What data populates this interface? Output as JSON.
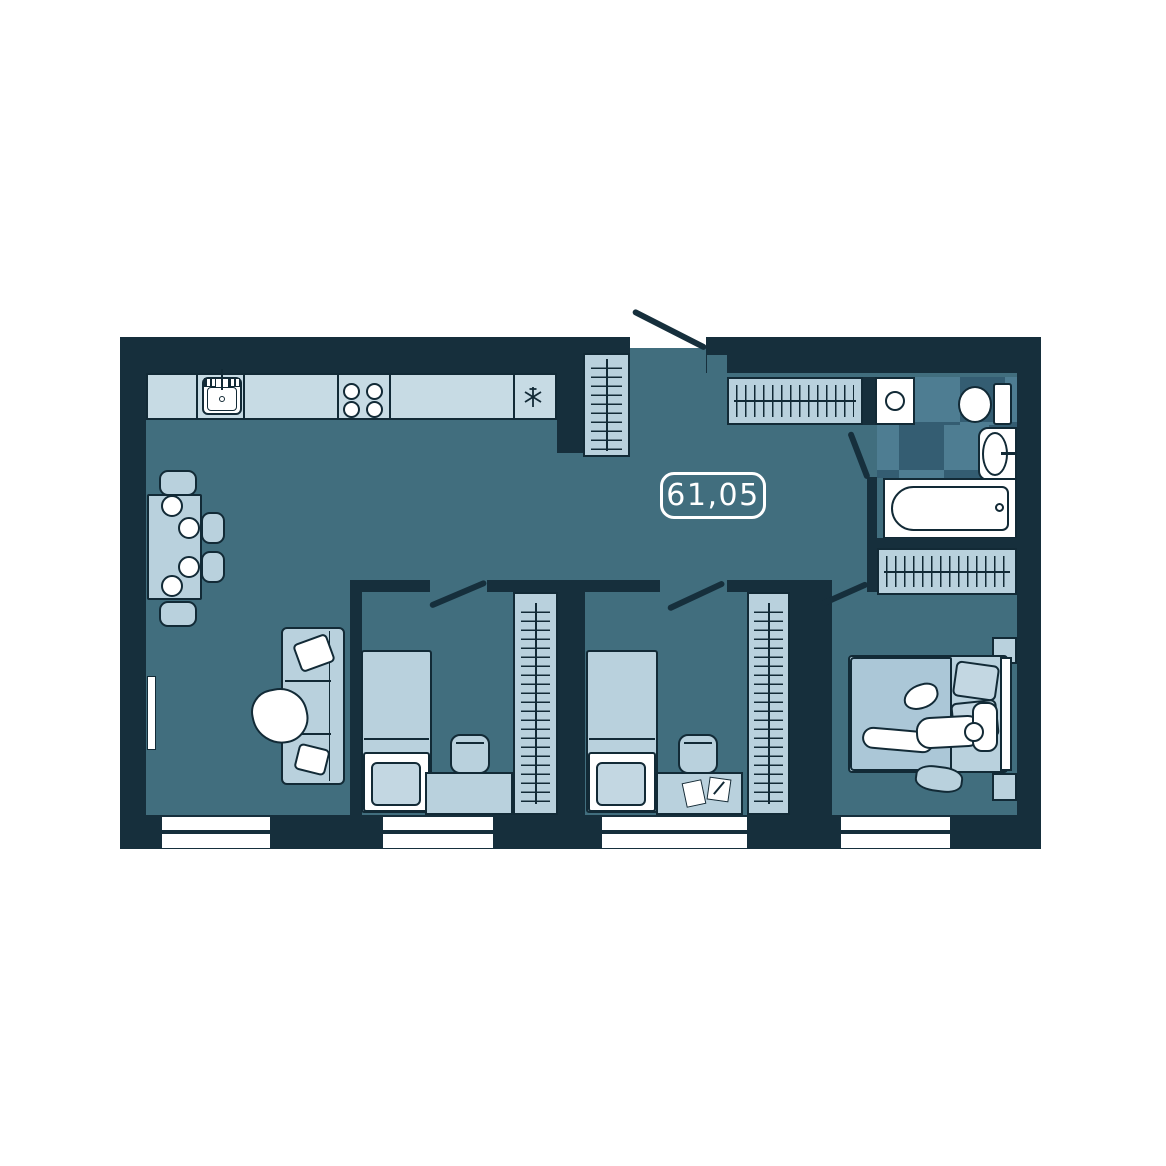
{
  "floorplan": {
    "area_label": "61,05",
    "colors": {
      "background": "#ffffff",
      "wall": "#162f3c",
      "floor": "#416e7e",
      "furniture": "#b9d1dd",
      "counter": "#c7dbe4",
      "blanket": "#abc7d7",
      "pillow": "#c3d7e2",
      "fixture_white": "#ffffff",
      "outline": "#122a36",
      "tile_light": "#4e7d92",
      "tile_dark": "#345d72",
      "label_text": "#ffffff"
    },
    "fixtures": [
      "kitchen-counter",
      "kitchen-sink",
      "stove",
      "fridge",
      "hall-wardrobe",
      "entry-door",
      "coat-closet",
      "washing-machine",
      "toilet",
      "washbasin",
      "bathtub",
      "linen-closet",
      "dining-table",
      "dining-chair",
      "plate",
      "sofa",
      "tv",
      "single-bed",
      "desk",
      "desk-chair",
      "wardrobe",
      "double-bed",
      "nightstand",
      "person",
      "cat",
      "window"
    ]
  }
}
